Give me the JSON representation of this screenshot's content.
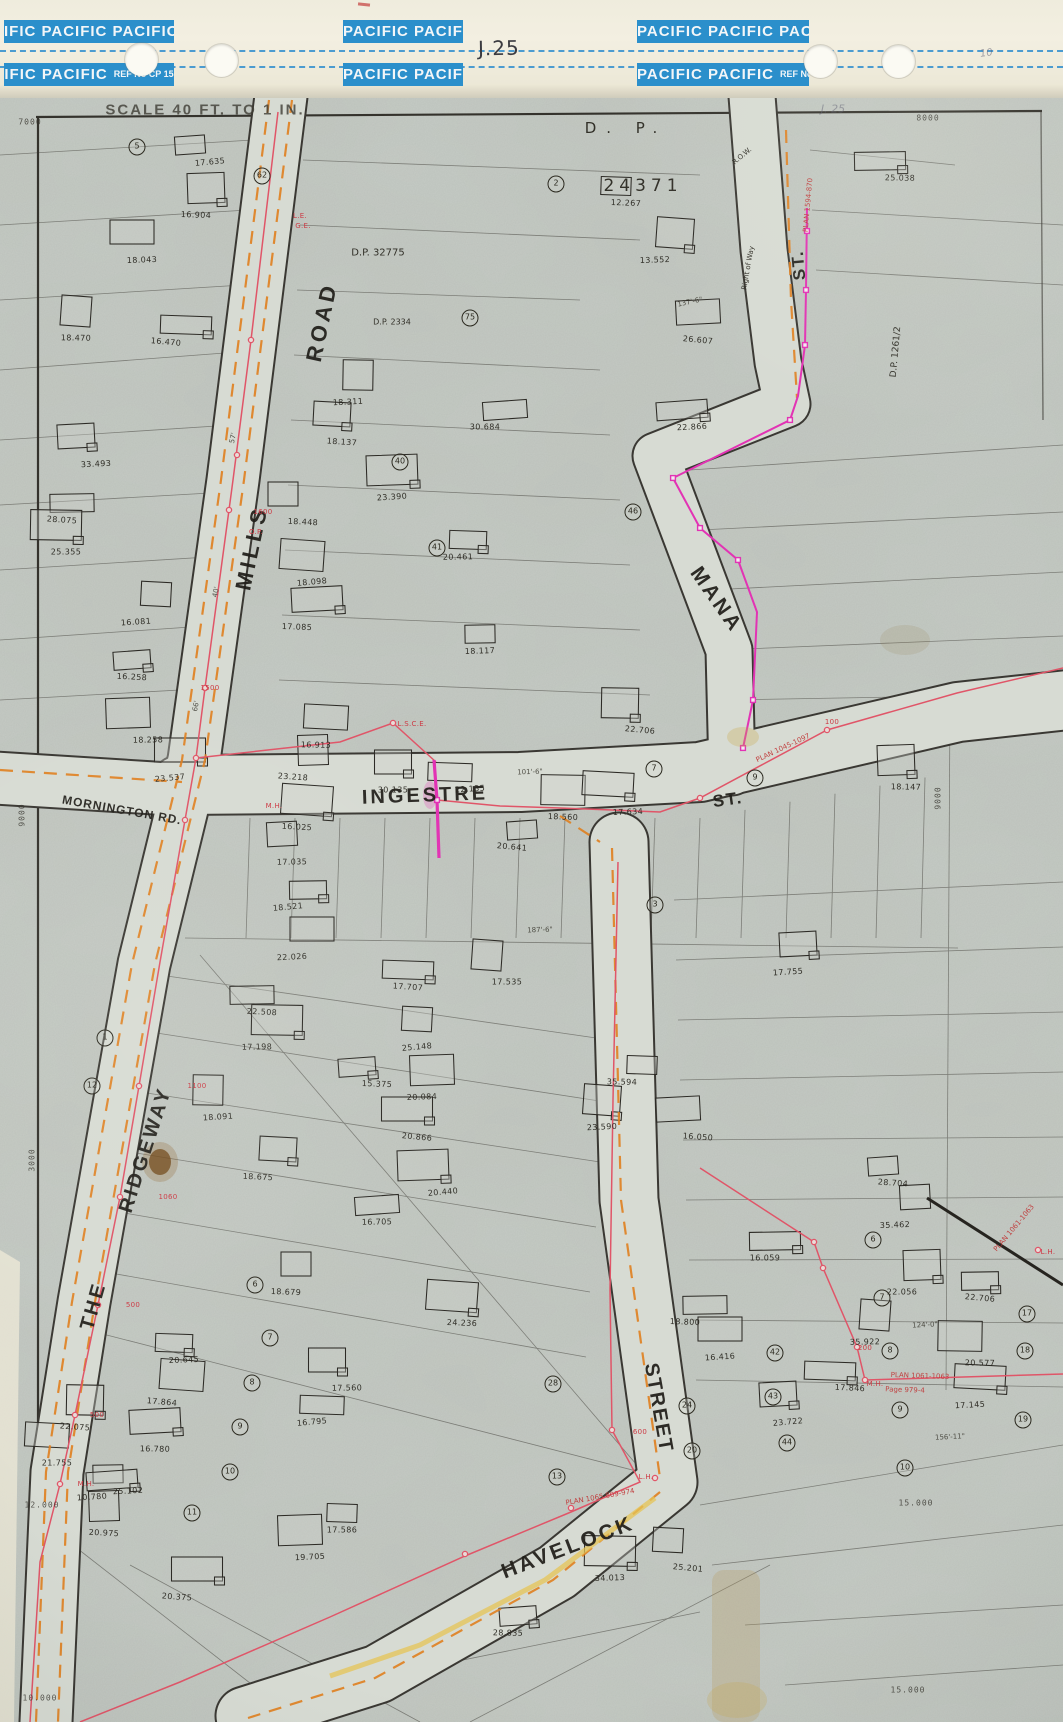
{
  "header": {
    "bands": {
      "r1l": "IFIC PACIFIC PACIFIC",
      "r1m": "PACIFIC PACIFIC",
      "r1r": "PACIFIC PACIFIC PACIFIC",
      "r2l": "IFIC PACIFIC",
      "r2m": "PACIFIC PACIFIC",
      "r2r": "PACIFIC PACIFIC",
      "ref": "REF No CP 15"
    },
    "page_number": "J.25",
    "pencil_note": "10"
  },
  "map": {
    "scale_text": "SCALE 40 FT. TO 1 IN.",
    "pencil_page": "J. 25",
    "streets": [
      {
        "t": "MILLS",
        "x": 252,
        "y": 548,
        "r": -78,
        "s": 22,
        "ls": 4
      },
      {
        "t": "ROAD",
        "x": 322,
        "y": 322,
        "r": -78,
        "s": 22,
        "ls": 4
      },
      {
        "t": "MANA",
        "x": 716,
        "y": 600,
        "r": 55,
        "s": 21,
        "ls": 3
      },
      {
        "t": "ST.",
        "x": 799,
        "y": 265,
        "r": -95,
        "s": 17,
        "ls": 2
      },
      {
        "t": "INGESTRE",
        "x": 425,
        "y": 796,
        "r": -2,
        "s": 20,
        "ls": 3
      },
      {
        "t": "ST.",
        "x": 728,
        "y": 800,
        "r": -8,
        "s": 17,
        "ls": 2
      },
      {
        "t": "MORNINGTON RD.",
        "x": 122,
        "y": 810,
        "r": 10,
        "s": 12,
        "ls": 1
      },
      {
        "t": "THE",
        "x": 94,
        "y": 1306,
        "r": -74,
        "s": 20,
        "ls": 3
      },
      {
        "t": "RIDGEWAY",
        "x": 146,
        "y": 1150,
        "r": -72,
        "s": 20,
        "ls": 3
      },
      {
        "t": "HAVELOCK",
        "x": 568,
        "y": 1548,
        "r": -21,
        "s": 21,
        "ls": 3
      },
      {
        "t": "STREET",
        "x": 658,
        "y": 1408,
        "r": 80,
        "s": 20,
        "ls": 2
      }
    ],
    "plan_labels": [
      {
        "t": "D.    P.",
        "x": 626,
        "y": 128,
        "s": 15,
        "ls": 10
      },
      {
        "t": "24371",
        "x": 643,
        "y": 186,
        "s": 17,
        "ls": 5
      },
      {
        "t": "D.P. 32775",
        "x": 378,
        "y": 253,
        "s": 10
      },
      {
        "t": "D.P. 2334",
        "x": 392,
        "y": 322,
        "s": 8
      },
      {
        "t": "D.P. 1261/2",
        "x": 896,
        "y": 352,
        "r": -85,
        "s": 9
      },
      {
        "t": "Right of Way",
        "x": 748,
        "y": 268,
        "r": -80,
        "s": 7
      },
      {
        "t": "R.O.W.",
        "x": 742,
        "y": 156,
        "r": -40,
        "s": 7
      }
    ],
    "plan_annotations": [
      {
        "t": "PLAN 1594-870",
        "x": 808,
        "y": 205,
        "r": -85,
        "s": 7
      },
      {
        "t": "PLAN 1045-1097",
        "x": 783,
        "y": 748,
        "r": -25,
        "s": 7
      },
      {
        "t": "PLAN 1065  809-974",
        "x": 600,
        "y": 1497,
        "r": -10,
        "s": 7
      },
      {
        "t": "PLAN 1061-1063",
        "x": 920,
        "y": 1376,
        "r": 2,
        "s": 7
      },
      {
        "t": "Page 979-4",
        "x": 905,
        "y": 1390,
        "r": 2,
        "s": 7
      },
      {
        "t": "PLAN 1061-1063",
        "x": 1014,
        "y": 1228,
        "r": -50,
        "s": 7
      }
    ],
    "utility_labels": [
      [
        "1600",
        263,
        512
      ],
      [
        "1500",
        210,
        688
      ],
      [
        "1100",
        197,
        1086
      ],
      [
        "1060",
        168,
        1197
      ],
      [
        "500",
        133,
        1305
      ],
      [
        "500",
        97,
        1415
      ],
      [
        "600",
        640,
        1432
      ],
      [
        "200",
        865,
        1348
      ],
      [
        "100",
        832,
        722
      ],
      [
        "L.S.C.E.",
        412,
        724
      ],
      [
        "L.E.",
        300,
        216
      ],
      [
        "G.E.",
        303,
        226
      ],
      [
        "M.H.",
        86,
        1484
      ],
      [
        "M.H.",
        274,
        806
      ],
      [
        "L.H.",
        1048,
        1252
      ],
      [
        "L.H.",
        646,
        1477
      ],
      [
        "O.P.",
        256,
        532
      ],
      [
        "M.H.",
        875,
        1384
      ]
    ],
    "grid_labels": [
      [
        "7000",
        30,
        122,
        0
      ],
      [
        "8000",
        928,
        118,
        0
      ],
      [
        "9000",
        22,
        815,
        -90
      ],
      [
        "9000",
        938,
        798,
        -90
      ],
      [
        "3000",
        32,
        1160,
        -90
      ],
      [
        "12.000",
        42,
        1505,
        0
      ],
      [
        "10.000",
        40,
        1698,
        0
      ],
      [
        "15.000",
        916,
        1503,
        0
      ],
      [
        "15.000",
        908,
        1690,
        0
      ]
    ],
    "dimensions": [
      [
        "57'",
        233,
        438,
        -78
      ],
      [
        "40'",
        216,
        592,
        -78
      ],
      [
        "66'",
        196,
        706,
        -78
      ],
      [
        "137'-6\"",
        690,
        302,
        -12
      ],
      [
        "124'-0\"",
        925,
        1325,
        -3
      ],
      [
        "156'-11\"",
        950,
        1437,
        -3
      ],
      [
        "101'-6\"",
        530,
        772,
        -2
      ],
      [
        "187'-6\"",
        540,
        930,
        -2
      ]
    ],
    "parcels": [
      [
        "17.635",
        210,
        162
      ],
      [
        "16.904",
        196,
        215
      ],
      [
        "18.043",
        142,
        260
      ],
      [
        "16.470",
        166,
        342
      ],
      [
        "18.470",
        76,
        338
      ],
      [
        "33.493",
        96,
        464
      ],
      [
        "28.075",
        62,
        520
      ],
      [
        "25.355",
        66,
        552
      ],
      [
        "16.081",
        136,
        622
      ],
      [
        "16.258",
        132,
        677
      ],
      [
        "18.258",
        148,
        740
      ],
      [
        "23.537",
        170,
        778
      ],
      [
        "12.267",
        626,
        203
      ],
      [
        "13.552",
        655,
        260
      ],
      [
        "26.607",
        698,
        340
      ],
      [
        "25.038",
        900,
        178
      ],
      [
        "18.311",
        348,
        402
      ],
      [
        "18.137",
        342,
        442
      ],
      [
        "30.684",
        485,
        427
      ],
      [
        "23.390",
        392,
        497
      ],
      [
        "18.448",
        303,
        522
      ],
      [
        "20.461",
        458,
        557
      ],
      [
        "18.098",
        312,
        582
      ],
      [
        "17.085",
        297,
        627
      ],
      [
        "18.117",
        480,
        651
      ],
      [
        "22.706",
        640,
        730
      ],
      [
        "16.913",
        316,
        745
      ],
      [
        "22.866",
        692,
        427
      ],
      [
        "23.218",
        293,
        777
      ],
      [
        "30.135",
        393,
        790
      ],
      [
        "22.135",
        470,
        789
      ],
      [
        "16.025",
        297,
        827
      ],
      [
        "17.035",
        292,
        862
      ],
      [
        "18.521",
        288,
        907
      ],
      [
        "18.560",
        563,
        817
      ],
      [
        "17.634",
        628,
        812
      ],
      [
        "20.641",
        512,
        847
      ],
      [
        "18.147",
        906,
        787
      ],
      [
        "22.026",
        292,
        957
      ],
      [
        "17.707",
        408,
        987
      ],
      [
        "17.535",
        507,
        982
      ],
      [
        "17.755",
        788,
        972
      ],
      [
        "22.508",
        262,
        1012
      ],
      [
        "17.198",
        257,
        1047
      ],
      [
        "25.148",
        417,
        1047
      ],
      [
        "15.375",
        377,
        1084
      ],
      [
        "20.084",
        422,
        1097
      ],
      [
        "20.866",
        417,
        1137
      ],
      [
        "35.594",
        622,
        1082
      ],
      [
        "23.590",
        602,
        1127
      ],
      [
        "16.050",
        698,
        1137
      ],
      [
        "16.059",
        765,
        1258
      ],
      [
        "18.091",
        218,
        1117
      ],
      [
        "18.675",
        258,
        1177
      ],
      [
        "16.705",
        377,
        1222
      ],
      [
        "20.440",
        443,
        1192
      ],
      [
        "18.679",
        286,
        1292
      ],
      [
        "20.645",
        184,
        1360
      ],
      [
        "17.864",
        162,
        1402
      ],
      [
        "16.780",
        155,
        1449
      ],
      [
        "25.102",
        128,
        1491
      ],
      [
        "22.075",
        75,
        1427
      ],
      [
        "21.755",
        57,
        1463
      ],
      [
        "10.780",
        92,
        1497
      ],
      [
        "20.975",
        104,
        1533
      ],
      [
        "17.560",
        347,
        1388
      ],
      [
        "16.795",
        312,
        1422
      ],
      [
        "24.236",
        462,
        1323
      ],
      [
        "35.462",
        895,
        1225
      ],
      [
        "22.706",
        980,
        1298
      ],
      [
        "20.577",
        980,
        1363
      ],
      [
        "17.145",
        970,
        1405
      ],
      [
        "28.704",
        893,
        1183
      ],
      [
        "22.056",
        902,
        1292
      ],
      [
        "16.416",
        720,
        1357
      ],
      [
        "17.846",
        850,
        1388
      ],
      [
        "35.922",
        865,
        1342
      ],
      [
        "23.722",
        788,
        1422
      ],
      [
        "18.800",
        685,
        1322
      ],
      [
        "34.013",
        610,
        1578
      ],
      [
        "25.201",
        688,
        1568
      ],
      [
        "28.835",
        508,
        1633
      ],
      [
        "19.705",
        310,
        1557
      ],
      [
        "20.375",
        177,
        1597
      ],
      [
        "17.586",
        342,
        1530
      ]
    ],
    "lots": [
      [
        5,
        137,
        147
      ],
      [
        62,
        262,
        176
      ],
      [
        2,
        556,
        184
      ],
      [
        75,
        470,
        318
      ],
      [
        40,
        400,
        462
      ],
      [
        41,
        437,
        548
      ],
      [
        46,
        633,
        512
      ],
      [
        9,
        755,
        778
      ],
      [
        7,
        654,
        769
      ],
      [
        3,
        655,
        905
      ],
      [
        1,
        105,
        1038
      ],
      [
        12,
        92,
        1086
      ],
      [
        28,
        553,
        1384
      ],
      [
        13,
        557,
        1477
      ],
      [
        24,
        687,
        1406
      ],
      [
        20,
        692,
        1451
      ],
      [
        6,
        873,
        1240
      ],
      [
        7,
        882,
        1298
      ],
      [
        8,
        890,
        1351
      ],
      [
        9,
        900,
        1410
      ],
      [
        10,
        905,
        1468
      ],
      [
        42,
        775,
        1353
      ],
      [
        43,
        773,
        1397
      ],
      [
        44,
        787,
        1443
      ],
      [
        6,
        255,
        1285
      ],
      [
        7,
        270,
        1338
      ],
      [
        8,
        252,
        1383
      ],
      [
        9,
        240,
        1427
      ],
      [
        10,
        230,
        1472
      ],
      [
        11,
        192,
        1513
      ],
      [
        17,
        1027,
        1314
      ],
      [
        18,
        1025,
        1351
      ],
      [
        19,
        1023,
        1420
      ]
    ],
    "colors": {
      "band_blue": "#2b8fcb",
      "paper": "#c6ccc6",
      "header_paper": "#f1edde",
      "ink": "#2d2b26",
      "road_fill": "#d7dbd3",
      "orange": "#e0801f",
      "pink": "#e05568",
      "magenta": "#e233b4",
      "yellow": "#e5c455",
      "red": "#c03a3a"
    }
  }
}
